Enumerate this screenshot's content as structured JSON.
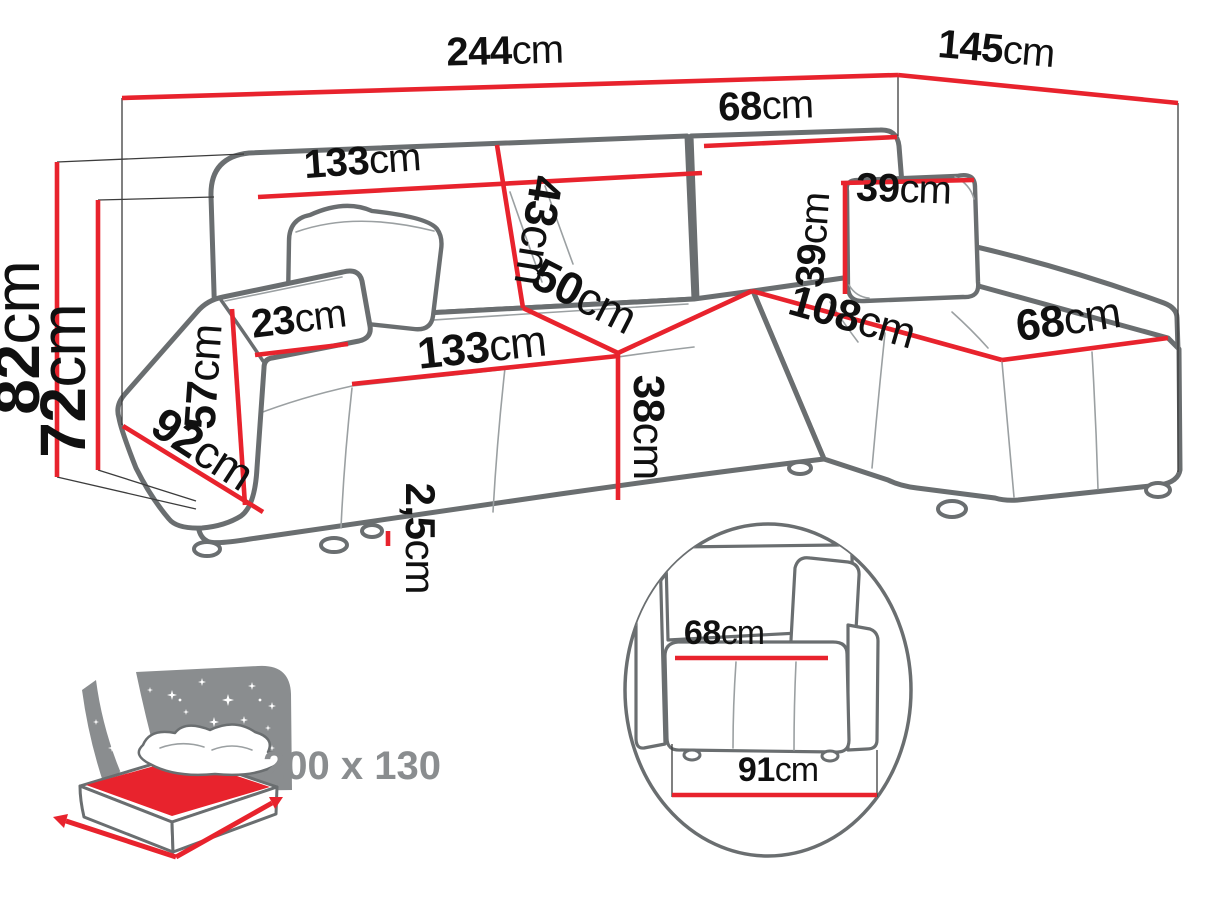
{
  "diagram_type": "corner-sofa-dimension-diagram",
  "colors": {
    "dimension_line": "#e8232d",
    "sofa_outline": "#6a6e70",
    "label_text": "#101010",
    "inset_gray": "#8a8d8f",
    "bed_surface_red": "#e8232d"
  },
  "dimensions": {
    "width_total": {
      "value": "244",
      "unit": "cm"
    },
    "depth_total": {
      "value": "145",
      "unit": "cm"
    },
    "height_total": {
      "value": "82",
      "unit": "cm"
    },
    "height_backrest": {
      "value": "72",
      "unit": "cm"
    },
    "backrest_left_width": {
      "value": "133",
      "unit": "cm"
    },
    "backrest_right_width": {
      "value": "68",
      "unit": "cm"
    },
    "backrest_height": {
      "value": "43",
      "unit": "cm"
    },
    "corner_width": {
      "value": "50",
      "unit": "cm"
    },
    "pillow_width": {
      "value": "39",
      "unit": "cm"
    },
    "pillow_height": {
      "value": "39",
      "unit": "cm"
    },
    "chaise_length": {
      "value": "108",
      "unit": "cm"
    },
    "chaise_width": {
      "value": "68",
      "unit": "cm"
    },
    "armrest_width": {
      "value": "23",
      "unit": "cm"
    },
    "armrest_height": {
      "value": "57",
      "unit": "cm"
    },
    "seat_width": {
      "value": "133",
      "unit": "cm"
    },
    "seat_front_height": {
      "value": "38",
      "unit": "cm"
    },
    "side_depth": {
      "value": "92",
      "unit": "cm"
    },
    "leg_height": {
      "value": "2,5",
      "unit": "cm"
    }
  },
  "side_detail": {
    "seat_depth": {
      "value": "68",
      "unit": "cm"
    },
    "total_depth": {
      "value": "91",
      "unit": "cm"
    }
  },
  "sleeping_area": {
    "size_label": "200 x 130"
  }
}
